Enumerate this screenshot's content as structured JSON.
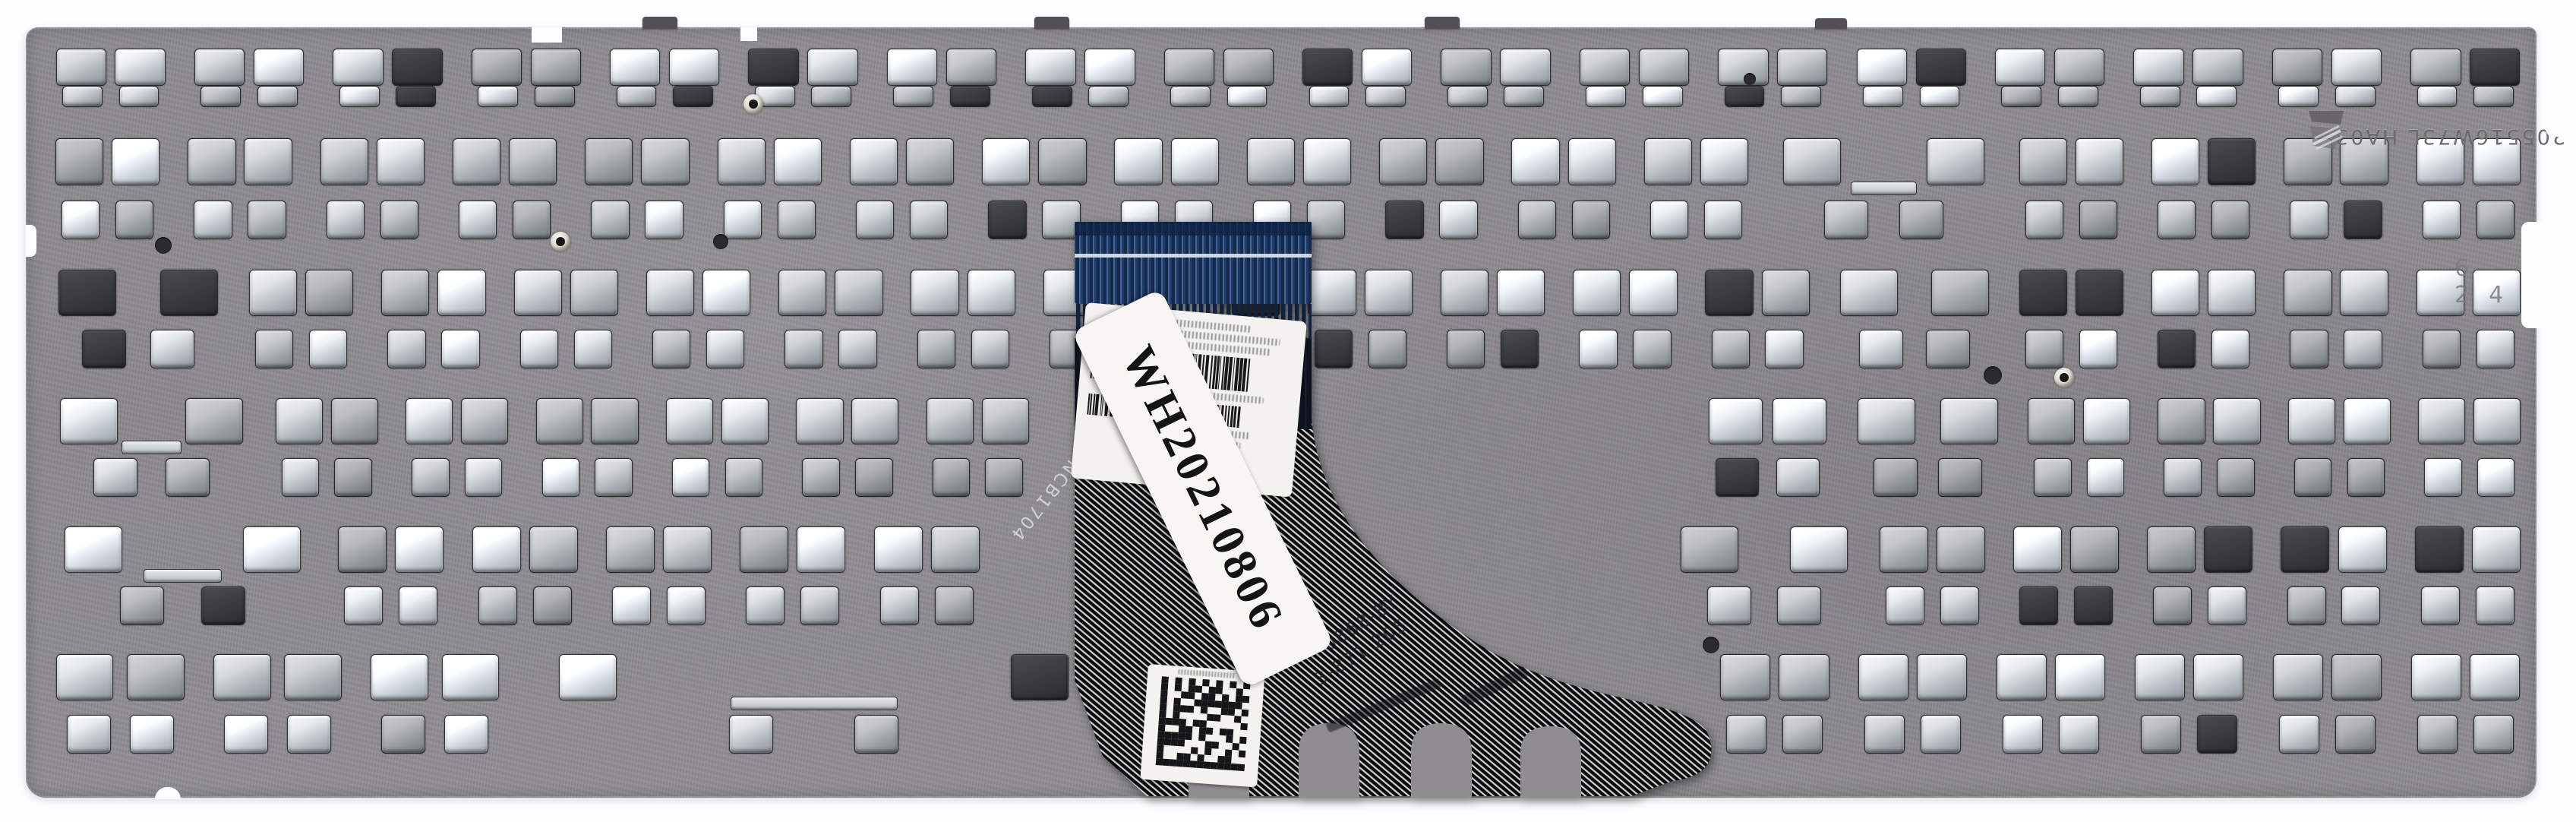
{
  "page": {
    "background": "#fcfdfe"
  },
  "plate": {
    "stamp_code": "205516W73L HA03",
    "edge_stamp": "6 24",
    "color": "#8e8c8f",
    "hole_highlight": "#e9edf0"
  },
  "cable": {
    "handwritten_label": "WH20210806",
    "side_print": "NCB1704",
    "print_line1": "0868-BY",
    "print_line2": "3-871 205",
    "connector_color": "#1d3c69",
    "body_color": "#0b0b0d",
    "label_color": "#f3f2ee"
  },
  "icons": {
    "logo_stamp": "stamped-maker-emblem-icon",
    "barcode_label": "barcode-icon",
    "qr_label": "data-matrix-icon"
  }
}
